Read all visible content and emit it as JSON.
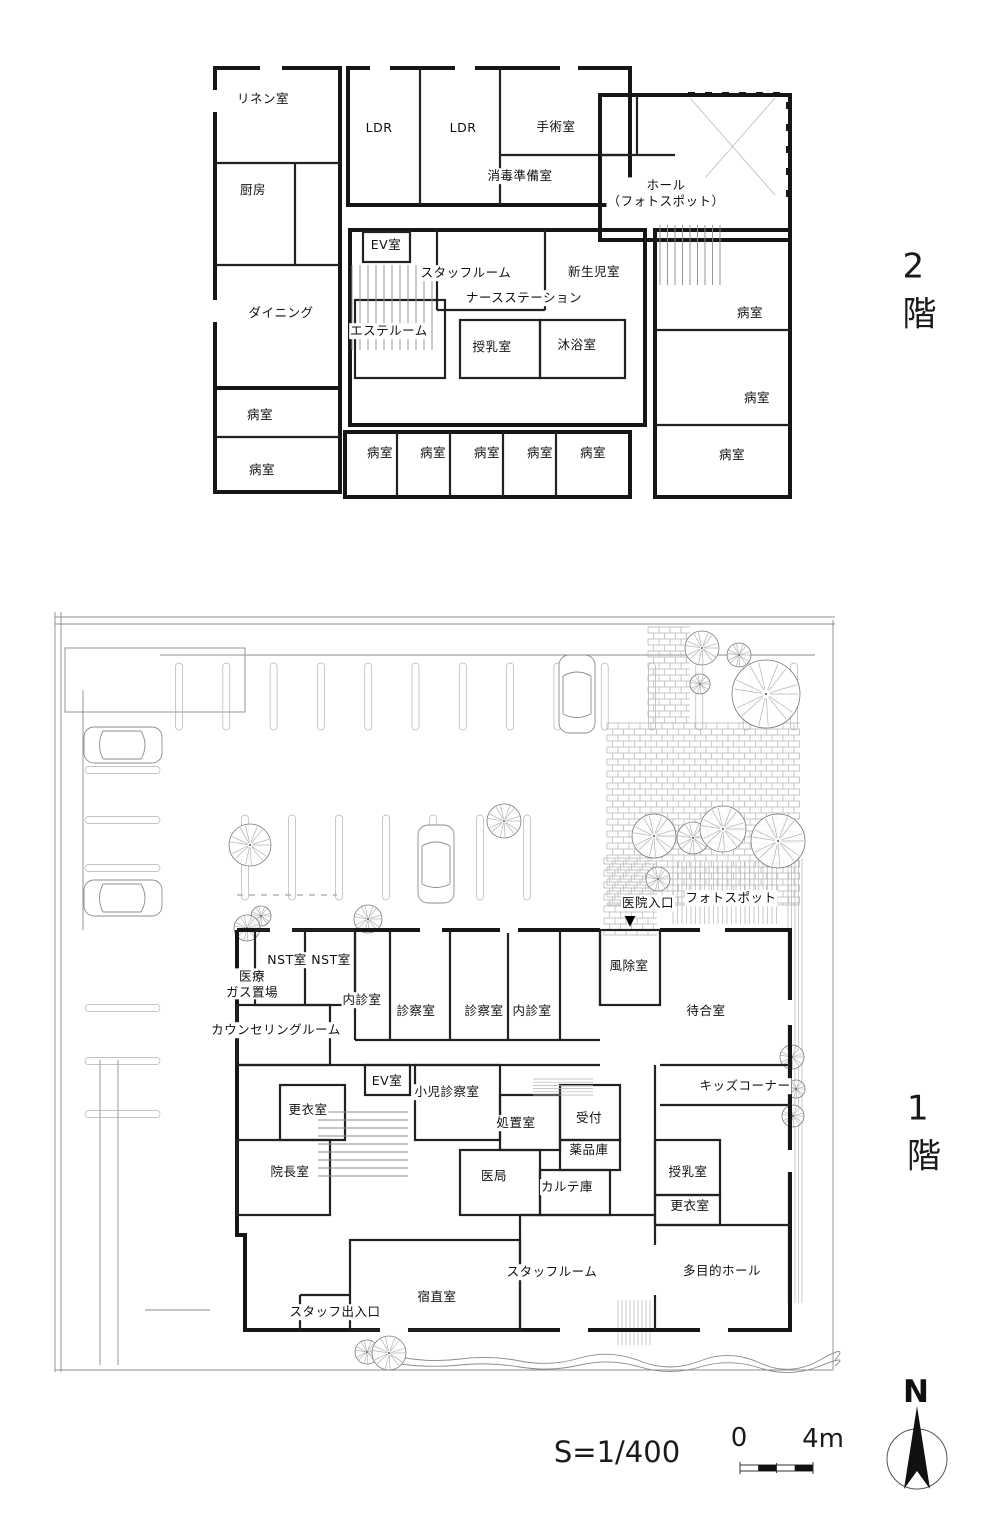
{
  "floor_tags": {
    "second": "2 階",
    "first": "1 階"
  },
  "scale": {
    "text": "S=1/400",
    "zero": "0",
    "four_m": "4m"
  },
  "compass": {
    "north": "N"
  },
  "entrance": {
    "label": "医院入口",
    "marker": "▼"
  },
  "colors": {
    "wall": "#161616",
    "thin_line": "#8c8c8c",
    "light_line": "#b3b3b3"
  },
  "floor2": {
    "name": "2階",
    "rooms": [
      {
        "t": "リネン室",
        "x": 263,
        "y": 99
      },
      {
        "t": "LDR",
        "x": 379,
        "y": 128
      },
      {
        "t": "LDR",
        "x": 463,
        "y": 128
      },
      {
        "t": "手術室",
        "x": 556,
        "y": 127
      },
      {
        "t": "消毒準備室",
        "x": 520,
        "y": 176
      },
      {
        "t": "厨房",
        "x": 253,
        "y": 190
      },
      {
        "t": "ホール\n（フォトスポット）",
        "x": 666,
        "y": 193
      },
      {
        "t": "EV室",
        "x": 386,
        "y": 245
      },
      {
        "t": "スタッフルーム",
        "x": 466,
        "y": 273
      },
      {
        "t": "新生児室",
        "x": 594,
        "y": 272
      },
      {
        "t": "ナースステーション",
        "x": 524,
        "y": 298
      },
      {
        "t": "ダイニング",
        "x": 281,
        "y": 313
      },
      {
        "t": "エステルーム",
        "x": 389,
        "y": 331
      },
      {
        "t": "授乳室",
        "x": 492,
        "y": 347
      },
      {
        "t": "沐浴室",
        "x": 577,
        "y": 345
      },
      {
        "t": "病室",
        "x": 260,
        "y": 415
      },
      {
        "t": "病室",
        "x": 750,
        "y": 313
      },
      {
        "t": "病室",
        "x": 757,
        "y": 398
      },
      {
        "t": "病室",
        "x": 262,
        "y": 470
      },
      {
        "t": "病室",
        "x": 380,
        "y": 453
      },
      {
        "t": "病室",
        "x": 433,
        "y": 453
      },
      {
        "t": "病室",
        "x": 487,
        "y": 453
      },
      {
        "t": "病室",
        "x": 540,
        "y": 453
      },
      {
        "t": "病室",
        "x": 593,
        "y": 453
      },
      {
        "t": "病室",
        "x": 732,
        "y": 455
      }
    ]
  },
  "floor1": {
    "name": "1階",
    "rooms": [
      {
        "t": "フォトスポット",
        "x": 731,
        "y": 898
      },
      {
        "t": "NST室",
        "x": 287,
        "y": 960
      },
      {
        "t": "NST室",
        "x": 331,
        "y": 960
      },
      {
        "t": "医療\nガス置場",
        "x": 252,
        "y": 984
      },
      {
        "t": "風除室",
        "x": 629,
        "y": 966
      },
      {
        "t": "内診室",
        "x": 362,
        "y": 1000
      },
      {
        "t": "診察室",
        "x": 416,
        "y": 1011
      },
      {
        "t": "診察室",
        "x": 484,
        "y": 1011
      },
      {
        "t": "内診室",
        "x": 532,
        "y": 1011
      },
      {
        "t": "待合室",
        "x": 706,
        "y": 1011
      },
      {
        "t": "カウンセリングルーム",
        "x": 276,
        "y": 1030
      },
      {
        "t": "EV室",
        "x": 387,
        "y": 1081
      },
      {
        "t": "小児診察室",
        "x": 447,
        "y": 1092
      },
      {
        "t": "キッズコーナー",
        "x": 745,
        "y": 1086
      },
      {
        "t": "更衣室",
        "x": 308,
        "y": 1110
      },
      {
        "t": "処置室",
        "x": 516,
        "y": 1123
      },
      {
        "t": "受付",
        "x": 589,
        "y": 1118
      },
      {
        "t": "薬品庫",
        "x": 589,
        "y": 1150
      },
      {
        "t": "院長室",
        "x": 290,
        "y": 1172
      },
      {
        "t": "医局",
        "x": 494,
        "y": 1176
      },
      {
        "t": "カルテ庫",
        "x": 567,
        "y": 1187
      },
      {
        "t": "授乳室",
        "x": 688,
        "y": 1172
      },
      {
        "t": "更衣室",
        "x": 690,
        "y": 1206
      },
      {
        "t": "スタッフルーム",
        "x": 552,
        "y": 1272
      },
      {
        "t": "多目的ホール",
        "x": 722,
        "y": 1271
      },
      {
        "t": "宿直室",
        "x": 437,
        "y": 1297
      },
      {
        "t": "スタッフ出入口",
        "x": 335,
        "y": 1312
      }
    ]
  },
  "site": {
    "trees": [
      {
        "x": 702,
        "y": 648,
        "r": 17
      },
      {
        "x": 739,
        "y": 655,
        "r": 12
      },
      {
        "x": 700,
        "y": 684,
        "r": 10
      },
      {
        "x": 766,
        "y": 694,
        "r": 34
      },
      {
        "x": 654,
        "y": 836,
        "r": 22
      },
      {
        "x": 693,
        "y": 838,
        "r": 16
      },
      {
        "x": 723,
        "y": 829,
        "r": 23
      },
      {
        "x": 778,
        "y": 841,
        "r": 27
      },
      {
        "x": 658,
        "y": 879,
        "r": 12
      },
      {
        "x": 250,
        "y": 845,
        "r": 21
      },
      {
        "x": 261,
        "y": 916,
        "r": 10
      },
      {
        "x": 504,
        "y": 821,
        "r": 17
      },
      {
        "x": 247,
        "y": 928,
        "r": 13
      },
      {
        "x": 368,
        "y": 919,
        "r": 14
      },
      {
        "x": 792,
        "y": 1057,
        "r": 12
      },
      {
        "x": 796,
        "y": 1089,
        "r": 9
      },
      {
        "x": 793,
        "y": 1116,
        "r": 11
      },
      {
        "x": 367,
        "y": 1352,
        "r": 12
      },
      {
        "x": 389,
        "y": 1353,
        "r": 17
      }
    ],
    "cars": [
      {
        "x": 577,
        "y": 694,
        "dir": "v"
      },
      {
        "x": 123,
        "y": 745,
        "dir": "h"
      },
      {
        "x": 123,
        "y": 898,
        "dir": "h"
      },
      {
        "x": 436,
        "y": 864,
        "dir": "v"
      }
    ]
  }
}
